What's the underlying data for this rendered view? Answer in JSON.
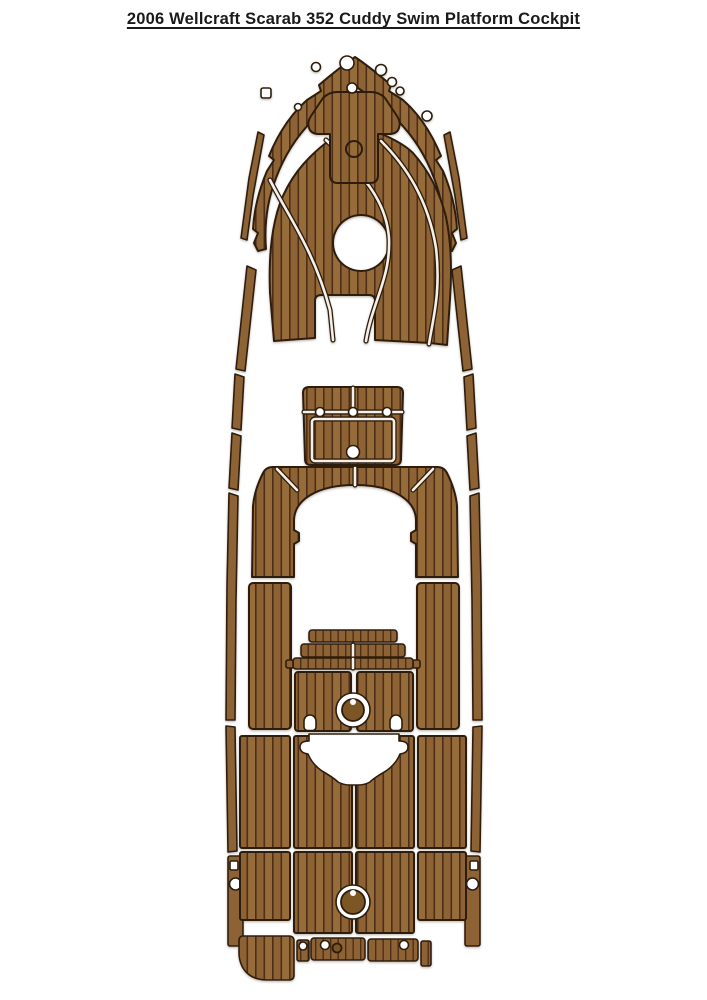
{
  "title": "2006 Wellcraft Scarab 352 Cuddy Swim Platform Cockpit",
  "figure": {
    "description": "Top-down layout of EVA faux-teak boat deck pads (brown planks with dark grooves) arranged in the outline of a boat: bow pad set, anchor locker pad, gunwale rail strips, cockpit hatch pad, cockpit entry arch pad, side deck pads, engine step pads, cockpit floor pads with hatch circles, swim platform pads with transom cutout, and stern trim pads.",
    "pieces": [
      "bow-rub-rail-band",
      "bow-main-pad",
      "anchor-locker-pad",
      "port-bow-trim-strip",
      "starboard-bow-trim-strip",
      "port-gunwale-rail",
      "starboard-gunwale-rail",
      "cockpit-hatch-pad",
      "cockpit-entry-arch-pad",
      "port-side-deck-pad",
      "starboard-side-deck-pad",
      "engine-step-pads",
      "cockpit-floor-pads",
      "swim-platform-pads",
      "stern-corner-pad",
      "stern-trim-strips"
    ]
  },
  "colors": {
    "background": "#ffffff",
    "plank": "#8d6434",
    "plank_alt": "#966c3a",
    "groove": "#4f2e13",
    "edge": "#2f1d0a",
    "gap": "#f4f0e9",
    "hub": "#7d5627",
    "title": "#1a1a1a"
  }
}
